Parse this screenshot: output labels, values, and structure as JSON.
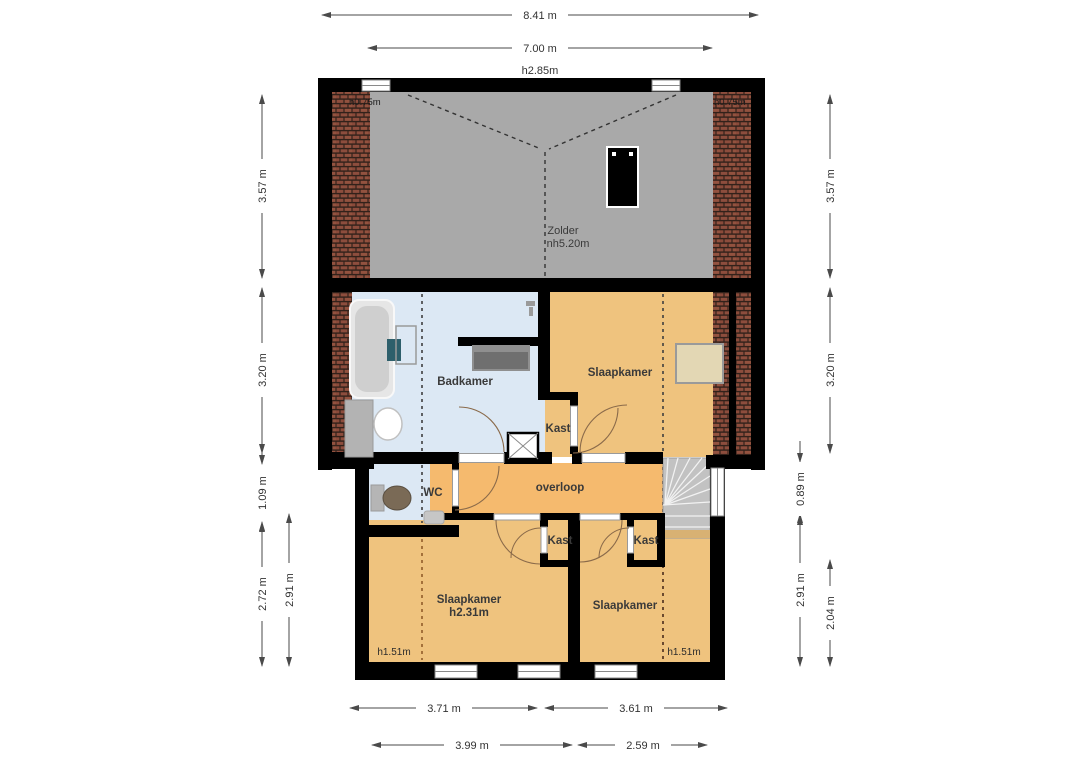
{
  "floorplan": {
    "rooms": {
      "zolder": {
        "label": "Zolder",
        "sub": "nh5.20m"
      },
      "badkamer": {
        "label": "Badkamer"
      },
      "slaapkamer_mid": {
        "label": "Slaapkamer"
      },
      "kast_mid": {
        "label": "Kast"
      },
      "wc": {
        "label": "WC"
      },
      "overloop": {
        "label": "overloop"
      },
      "slaapkamer_left": {
        "label": "Slaapkamer",
        "sub": "h2.31m"
      },
      "slaapkamer_right": {
        "label": "Slaapkamer"
      },
      "kast_left": {
        "label": "Kast"
      },
      "kast_right": {
        "label": "Kast"
      }
    },
    "heights": {
      "top": "h2.85m",
      "attic_left": "h0.75m",
      "attic_right": "h0.75m",
      "bottom_left": "h1.51m",
      "bottom_right": "h1.51m"
    },
    "dims": {
      "top_outer": "8.41 m",
      "top_inner": "7.00 m",
      "left": [
        "3.57 m",
        "3.20 m",
        "1.09 m",
        "2.72 m"
      ],
      "left_inner": "2.91 m",
      "right": [
        "3.57 m",
        "3.20 m",
        "2.04 m"
      ],
      "right_inner": [
        "0.89 m",
        "2.91 m"
      ],
      "bottom_inner": [
        "3.71 m",
        "3.61 m"
      ],
      "bottom_outer": [
        "3.99 m",
        "2.59 m"
      ]
    },
    "colors": {
      "wall": "#000000",
      "attic_floor": "#a9a9a9",
      "bathroom_floor": "#dce8f4",
      "bedroom_floor": "#efc37e",
      "overloop_floor": "#f5ba6e",
      "brick": "#8d4d3d",
      "stairs": "#c2c2c2",
      "dimension": "#4a4a4a"
    }
  }
}
